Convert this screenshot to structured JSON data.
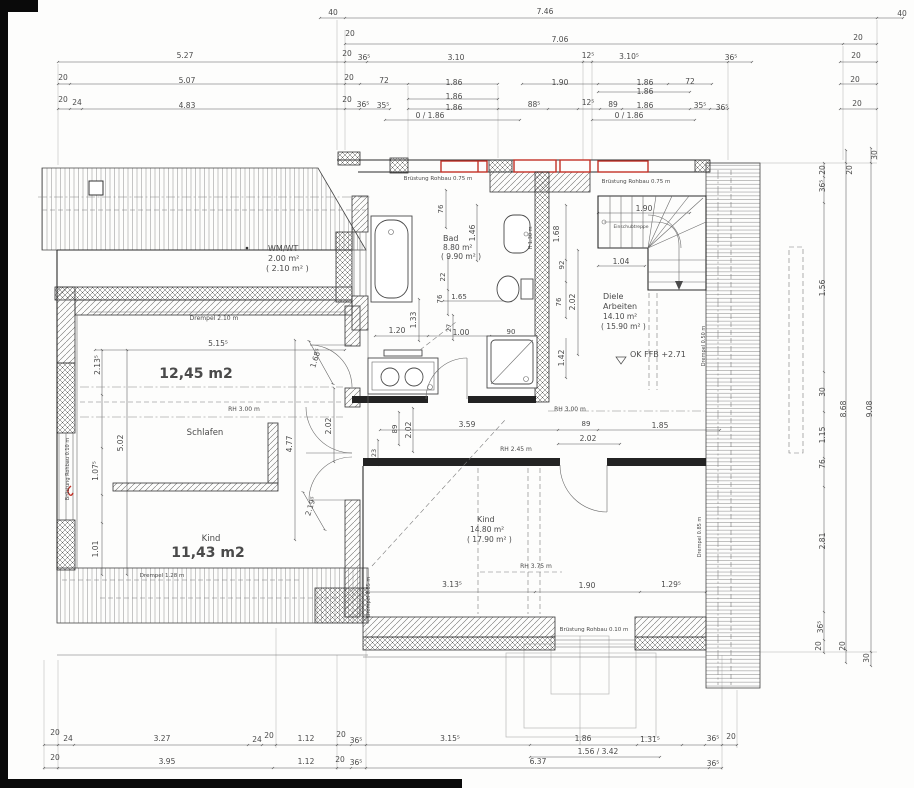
{
  "drawing": {
    "kind": "architectural floor plan (attic storey)",
    "language": "German"
  },
  "colors": {
    "paper": "#fdfdfc",
    "wall_line": "#2b2b2b",
    "dim_text": "#4a4a4a",
    "window_red": "#c23127",
    "annotation_black": "#0a0a0a"
  },
  "rooms": [
    {
      "name": "WM/WT",
      "area": "2.00 m²",
      "area_gross": "( 2.10 m² )"
    },
    {
      "name": "Schlafen",
      "area_annotation": "12,45 m2"
    },
    {
      "name": "Kind",
      "area_annotation": "11,43 m2"
    },
    {
      "name": "Bad",
      "area": "8.80 m²",
      "area_gross": "( 9.90 m² )"
    },
    {
      "name": "Diele Arbeiten",
      "area": "14.10 m²",
      "area_gross": "( 15.90 m² )"
    },
    {
      "name": "Kind",
      "area": "14.80 m²",
      "area_gross": "( 17.90 m² )"
    }
  ],
  "labels": {
    "top_dims": [
      {
        "n": "dim-40-top-left",
        "t": "40",
        "x": 333,
        "y": 15
      },
      {
        "n": "dim-746",
        "t": "7.46",
        "x": 545,
        "y": 14
      },
      {
        "n": "dim-40-top-right",
        "t": "40",
        "x": 902,
        "y": 16
      },
      {
        "n": "dim-20",
        "t": "20",
        "x": 350,
        "y": 36
      },
      {
        "n": "dim-706",
        "t": "7.06",
        "x": 560,
        "y": 42
      },
      {
        "n": "dim-20",
        "t": "20",
        "x": 858,
        "y": 40
      },
      {
        "n": "dim-527",
        "t": "5.27",
        "x": 185,
        "y": 58
      },
      {
        "n": "dim-20",
        "t": "20",
        "x": 347,
        "y": 56
      },
      {
        "n": "dim-365",
        "t": "36⁵",
        "x": 364,
        "y": 60
      },
      {
        "n": "dim-310",
        "t": "3.10",
        "x": 456,
        "y": 60
      },
      {
        "n": "dim-125",
        "t": "12⁵",
        "x": 588,
        "y": 58
      },
      {
        "n": "dim-3105",
        "t": "3.10⁵",
        "x": 629,
        "y": 59
      },
      {
        "n": "dim-365",
        "t": "36⁵",
        "x": 731,
        "y": 60
      },
      {
        "n": "dim-20",
        "t": "20",
        "x": 856,
        "y": 58
      },
      {
        "n": "dim-20",
        "t": "20",
        "x": 63,
        "y": 80
      },
      {
        "n": "dim-507",
        "t": "5.07",
        "x": 187,
        "y": 83
      },
      {
        "n": "dim-20",
        "t": "20",
        "x": 349,
        "y": 80
      },
      {
        "n": "dim-72",
        "t": "72",
        "x": 384,
        "y": 83
      },
      {
        "n": "dim-186",
        "t": "1.86",
        "x": 454,
        "y": 85
      },
      {
        "n": "dim-190",
        "t": "1.90",
        "x": 560,
        "y": 85
      },
      {
        "n": "dim-186",
        "t": "1.86",
        "x": 645,
        "y": 85
      },
      {
        "n": "dim-72",
        "t": "72",
        "x": 690,
        "y": 84
      },
      {
        "n": "dim-20",
        "t": "20",
        "x": 855,
        "y": 82
      },
      {
        "n": "dim-186",
        "t": "1.86",
        "x": 645,
        "y": 94
      },
      {
        "n": "dim-186",
        "t": "1.86",
        "x": 454,
        "y": 99
      },
      {
        "n": "dim-20",
        "t": "20",
        "x": 63,
        "y": 102
      },
      {
        "n": "dim-24",
        "t": "24",
        "x": 77,
        "y": 105
      },
      {
        "n": "dim-483",
        "t": "4.83",
        "x": 187,
        "y": 108
      },
      {
        "n": "dim-20",
        "t": "20",
        "x": 347,
        "y": 102
      },
      {
        "n": "dim-365",
        "t": "36⁵",
        "x": 363,
        "y": 107
      },
      {
        "n": "dim-355",
        "t": "35⁵",
        "x": 383,
        "y": 108
      },
      {
        "n": "dim-186",
        "t": "1.86",
        "x": 454,
        "y": 110
      },
      {
        "n": "dim-885",
        "t": "88⁵",
        "x": 534,
        "y": 107
      },
      {
        "n": "dim-125",
        "t": "12⁵",
        "x": 588,
        "y": 105
      },
      {
        "n": "dim-89",
        "t": "89",
        "x": 613,
        "y": 107
      },
      {
        "n": "dim-186",
        "t": "1.86",
        "x": 645,
        "y": 108
      },
      {
        "n": "dim-355",
        "t": "35⁵",
        "x": 700,
        "y": 108
      },
      {
        "n": "dim-365",
        "t": "36⁵",
        "x": 722,
        "y": 110
      },
      {
        "n": "dim-20",
        "t": "20",
        "x": 857,
        "y": 106
      },
      {
        "n": "dim-0-186",
        "t": "0 / 1.86",
        "x": 430,
        "y": 118
      },
      {
        "n": "dim-0-186",
        "t": "0 / 1.86",
        "x": 629,
        "y": 118
      }
    ],
    "right_dims": [
      {
        "n": "dim-30",
        "t": "30",
        "x": 877,
        "y": 155,
        "r": -90
      },
      {
        "n": "dim-20",
        "t": "20",
        "x": 825,
        "y": 170,
        "r": -90
      },
      {
        "n": "dim-20",
        "t": "20",
        "x": 852,
        "y": 170,
        "r": -90
      },
      {
        "n": "dim-365",
        "t": "36⁵",
        "x": 825,
        "y": 186,
        "r": -90
      },
      {
        "n": "dim-156",
        "t": "1.56",
        "x": 825,
        "y": 288,
        "r": -90
      },
      {
        "n": "dim-30",
        "t": "30",
        "x": 825,
        "y": 392,
        "r": -90
      },
      {
        "n": "dim-868",
        "t": "8.68",
        "x": 846,
        "y": 409,
        "r": -90
      },
      {
        "n": "dim-908",
        "t": "9.08",
        "x": 872,
        "y": 409,
        "r": -90
      },
      {
        "n": "dim-115",
        "t": "1.15",
        "x": 825,
        "y": 435,
        "r": -90
      },
      {
        "n": "dim-76",
        "t": "76",
        "x": 825,
        "y": 464,
        "r": -90
      },
      {
        "n": "dim-281",
        "t": "2.81",
        "x": 825,
        "y": 541,
        "r": -90
      },
      {
        "n": "dim-365",
        "t": "36⁵",
        "x": 823,
        "y": 627,
        "r": -90
      },
      {
        "n": "dim-20",
        "t": "20",
        "x": 821,
        "y": 646,
        "r": -90
      },
      {
        "n": "dim-20",
        "t": "20",
        "x": 845,
        "y": 646,
        "r": -90
      },
      {
        "n": "dim-30",
        "t": "30",
        "x": 869,
        "y": 658,
        "r": -90
      }
    ],
    "bottom_dims": [
      {
        "n": "dim-20",
        "t": "20",
        "x": 55,
        "y": 735
      },
      {
        "n": "dim-24",
        "t": "24",
        "x": 68,
        "y": 741
      },
      {
        "n": "dim-327",
        "t": "3.27",
        "x": 162,
        "y": 741
      },
      {
        "n": "dim-24",
        "t": "24",
        "x": 257,
        "y": 742
      },
      {
        "n": "dim-20",
        "t": "20",
        "x": 269,
        "y": 738
      },
      {
        "n": "dim-112",
        "t": "1.12",
        "x": 306,
        "y": 741
      },
      {
        "n": "dim-20",
        "t": "20",
        "x": 341,
        "y": 737
      },
      {
        "n": "dim-365",
        "t": "36⁵",
        "x": 356,
        "y": 743
      },
      {
        "n": "dim-3155",
        "t": "3.15⁵",
        "x": 450,
        "y": 741
      },
      {
        "n": "dim-186",
        "t": "1.86",
        "x": 583,
        "y": 741
      },
      {
        "n": "dim-1315",
        "t": "1.31⁵",
        "x": 650,
        "y": 742
      },
      {
        "n": "dim-365",
        "t": "36⁵",
        "x": 713,
        "y": 741
      },
      {
        "n": "dim-20",
        "t": "20",
        "x": 731,
        "y": 739
      },
      {
        "n": "dim-156-342",
        "t": "1.56 / 3.42",
        "x": 598,
        "y": 754
      },
      {
        "n": "dim-20",
        "t": "20",
        "x": 55,
        "y": 760
      },
      {
        "n": "dim-395",
        "t": "3.95",
        "x": 167,
        "y": 764
      },
      {
        "n": "dim-112",
        "t": "1.12",
        "x": 306,
        "y": 764
      },
      {
        "n": "dim-20",
        "t": "20",
        "x": 340,
        "y": 762
      },
      {
        "n": "dim-365",
        "t": "36⁵",
        "x": 356,
        "y": 765
      },
      {
        "n": "dim-637",
        "t": "6.37",
        "x": 538,
        "y": 764
      },
      {
        "n": "dim-365",
        "t": "36⁵",
        "x": 713,
        "y": 766
      }
    ],
    "interior": [
      {
        "n": "room-label-wmwt",
        "t": "WM/WT",
        "x": 268,
        "y": 251,
        "a": "start",
        "s": 8,
        "c": "#333"
      },
      {
        "n": "room-area-wmwt",
        "t": "2.00 m²",
        "x": 268,
        "y": 261,
        "a": "start",
        "s": 8
      },
      {
        "n": "room-area-gross-wmwt",
        "t": "( 2.10 m² )",
        "x": 266,
        "y": 271,
        "a": "start",
        "s": 8
      },
      {
        "n": "note-drempel-210",
        "t": "Drempel 2.10 m",
        "x": 214,
        "y": 320,
        "s": 6
      },
      {
        "n": "dim-5155",
        "t": "5.15⁵",
        "x": 218,
        "y": 346
      },
      {
        "n": "area-annotation-schlafen",
        "t": "12,45 m2",
        "x": 196,
        "y": 378,
        "s": 14,
        "b": 1,
        "c": "#0a0a0a",
        "f": "Liberation Sans"
      },
      {
        "n": "dim-2135",
        "t": "2.13⁵",
        "x": 100,
        "y": 365,
        "r": -90
      },
      {
        "n": "note-rh-300-left",
        "t": "RH 3.00 m",
        "x": 244,
        "y": 411,
        "s": 6
      },
      {
        "n": "room-label-schlafen",
        "t": "Schlafen",
        "x": 205,
        "y": 435,
        "s": 8.5,
        "c": "#333"
      },
      {
        "n": "dim-502",
        "t": "5.02",
        "x": 123,
        "y": 443,
        "r": -90
      },
      {
        "n": "dim-1075",
        "t": "1.07⁵",
        "x": 98,
        "y": 471,
        "r": -90
      },
      {
        "n": "dim-101",
        "t": "1.01",
        "x": 98,
        "y": 549,
        "r": -90
      },
      {
        "n": "dim-477",
        "t": "4.77",
        "x": 292,
        "y": 444,
        "r": -90
      },
      {
        "n": "dim-1685",
        "t": "1.68⁵",
        "x": 318,
        "y": 359,
        "r": -72
      },
      {
        "n": "dim-202",
        "t": "2.02",
        "x": 331,
        "y": 426,
        "r": -90
      },
      {
        "n": "dim-2195",
        "t": "2.19⁵",
        "x": 313,
        "y": 507,
        "r": -72
      },
      {
        "n": "room-label-kind-left",
        "t": "Kind",
        "x": 211,
        "y": 541,
        "s": 8.5,
        "c": "#333"
      },
      {
        "n": "area-annotation-kind",
        "t": "11,43 m2",
        "x": 208,
        "y": 557,
        "s": 14,
        "b": 1,
        "c": "#0a0a0a",
        "f": "Liberation Sans"
      },
      {
        "n": "note-bruestung-010-left",
        "t": "Brüstung Rohbau 0.10 m",
        "x": 69,
        "y": 469,
        "r": -90,
        "s": 5
      },
      {
        "n": "note-drempel-128",
        "t": "Drempel 1.28 m",
        "x": 162,
        "y": 577,
        "s": 5.5
      },
      {
        "n": "note-bruestung-075-left",
        "t": "Brüstung Rohbau 0.75 m",
        "x": 438,
        "y": 180,
        "s": 5.5
      },
      {
        "n": "note-bruestung-075-right",
        "t": "Brüstung Rohbau 0.75 m",
        "x": 636,
        "y": 183,
        "s": 5.5
      },
      {
        "n": "dim-76",
        "t": "76",
        "x": 443,
        "y": 209,
        "r": -90,
        "s": 7
      },
      {
        "n": "dim-146",
        "t": "1.46",
        "x": 475,
        "y": 233,
        "r": -90
      },
      {
        "n": "room-label-bad",
        "t": "Bad",
        "x": 443,
        "y": 241,
        "a": "start",
        "s": 8,
        "c": "#333"
      },
      {
        "n": "room-area-bad",
        "t": "8.80 m²",
        "x": 443,
        "y": 250,
        "a": "start",
        "s": 7.5
      },
      {
        "n": "room-area-gross-bad",
        "t": "( 9.90 m² )",
        "x": 441,
        "y": 259,
        "a": "start",
        "s": 7.5
      },
      {
        "n": "dim-133",
        "t": "1.33",
        "x": 416,
        "y": 320,
        "r": -90
      },
      {
        "n": "dim-22",
        "t": "22",
        "x": 445,
        "y": 277,
        "r": -90,
        "s": 7
      },
      {
        "n": "dim-76",
        "t": "76",
        "x": 442,
        "y": 299,
        "r": -90,
        "s": 7
      },
      {
        "n": "dim-165",
        "t": "1.65",
        "x": 459,
        "y": 299,
        "s": 7
      },
      {
        "n": "dim-27",
        "t": "27",
        "x": 451,
        "y": 328,
        "r": -90,
        "s": 6.5
      },
      {
        "n": "dim-120",
        "t": "1.20",
        "x": 397,
        "y": 333
      },
      {
        "n": "dim-100",
        "t": "1.00",
        "x": 461,
        "y": 335
      },
      {
        "n": "dim-90",
        "t": "90",
        "x": 511,
        "y": 334,
        "s": 7
      },
      {
        "n": "note-h-130",
        "t": "H 1.30 m",
        "x": 532,
        "y": 238,
        "r": -90,
        "s": 5
      },
      {
        "n": "dim-168",
        "t": "1.68",
        "x": 559,
        "y": 234,
        "r": -90
      },
      {
        "n": "dim-92",
        "t": "92",
        "x": 564,
        "y": 265,
        "r": -90,
        "s": 7
      },
      {
        "n": "dim-76",
        "t": "76",
        "x": 561,
        "y": 302,
        "r": -90,
        "s": 7
      },
      {
        "n": "dim-202",
        "t": "2.02",
        "x": 575,
        "y": 302,
        "r": -90
      },
      {
        "n": "dim-142",
        "t": "1.42",
        "x": 564,
        "y": 358,
        "r": -90
      },
      {
        "n": "dim-190-stair",
        "t": "1.90",
        "x": 644,
        "y": 211
      },
      {
        "n": "stair-note",
        "t": "Einschubtreppe",
        "x": 631,
        "y": 228,
        "s": 4.5,
        "c": "#6a6a6a"
      },
      {
        "n": "dim-104",
        "t": "1.04",
        "x": 621,
        "y": 264
      },
      {
        "n": "room-label-diele",
        "t": "Diele",
        "x": 603,
        "y": 299,
        "a": "start",
        "s": 8,
        "c": "#333"
      },
      {
        "n": "room-label-arbeiten",
        "t": "Arbeiten",
        "x": 603,
        "y": 309,
        "a": "start",
        "s": 8,
        "c": "#333"
      },
      {
        "n": "room-area-diele",
        "t": "14.10 m²",
        "x": 603,
        "y": 319,
        "a": "start",
        "s": 7.5
      },
      {
        "n": "room-area-gross-diele",
        "t": "( 15.90 m² )",
        "x": 601,
        "y": 329,
        "a": "start",
        "s": 7.5
      },
      {
        "n": "level-annotation",
        "t": "OK FFB +2.71",
        "x": 630,
        "y": 357,
        "a": "start",
        "s": 8,
        "c": "#333"
      },
      {
        "n": "dim-89",
        "t": "89",
        "x": 397,
        "y": 429,
        "r": -90,
        "s": 7
      },
      {
        "n": "dim-202",
        "t": "2.02",
        "x": 411,
        "y": 430,
        "r": -90
      },
      {
        "n": "dim-359",
        "t": "3.59",
        "x": 467,
        "y": 427
      },
      {
        "n": "dim-89",
        "t": "89",
        "x": 586,
        "y": 426,
        "s": 7
      },
      {
        "n": "dim-202",
        "t": "2.02",
        "x": 588,
        "y": 441
      },
      {
        "n": "dim-185",
        "t": "1.85",
        "x": 660,
        "y": 428
      },
      {
        "n": "note-rh-245",
        "t": "RH 2.45 m",
        "x": 516,
        "y": 451,
        "s": 6
      },
      {
        "n": "note-rh-300-right",
        "t": "RH 3.00 m",
        "x": 570,
        "y": 411,
        "s": 6
      },
      {
        "n": "dim-23",
        "t": "23",
        "x": 376,
        "y": 453,
        "r": -90,
        "s": 6.5
      },
      {
        "n": "room-label-kind-right",
        "t": "Kind",
        "x": 477,
        "y": 522,
        "a": "start",
        "s": 8,
        "c": "#333"
      },
      {
        "n": "room-area-kind-right",
        "t": "14.80 m²",
        "x": 470,
        "y": 532,
        "a": "start",
        "s": 7.5
      },
      {
        "n": "room-area-gross-kind-right",
        "t": "( 17.90 m² )",
        "x": 467,
        "y": 542,
        "a": "start",
        "s": 7.5
      },
      {
        "n": "note-rh-375",
        "t": "RH 3.75 m",
        "x": 536,
        "y": 568,
        "s": 6
      },
      {
        "n": "dim-3135",
        "t": "3.13⁵",
        "x": 452,
        "y": 587
      },
      {
        "n": "dim-190",
        "t": "1.90",
        "x": 587,
        "y": 588
      },
      {
        "n": "dim-1295",
        "t": "1.29⁵",
        "x": 671,
        "y": 587
      },
      {
        "n": "note-bruestung-010-bottom",
        "t": "Brüstung Rohbau 0.10 m",
        "x": 594,
        "y": 631,
        "s": 5.5
      },
      {
        "n": "note-drempel-085-left",
        "t": "Drempel 0.85 m",
        "x": 370,
        "y": 597,
        "r": -90,
        "s": 5
      },
      {
        "n": "note-drempel-085-right",
        "t": "Drempel 0.85 m",
        "x": 701,
        "y": 537,
        "r": -90,
        "s": 5
      },
      {
        "n": "note-drempel-050-right",
        "t": "Drempel 0.50 m",
        "x": 705,
        "y": 346,
        "r": -90,
        "s": 5
      }
    ]
  }
}
